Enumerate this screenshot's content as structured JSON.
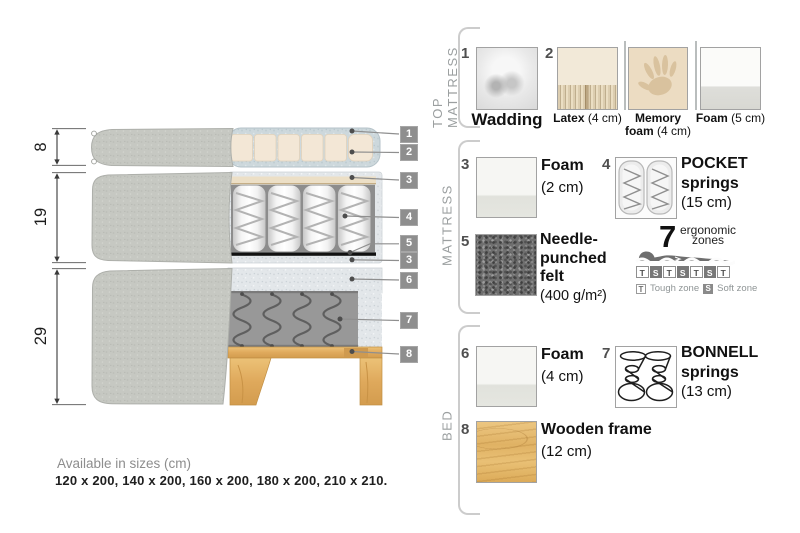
{
  "diagram": {
    "dim_top": "8",
    "dim_mid": "19",
    "dim_bottom": "29",
    "callouts": [
      "1",
      "2",
      "3",
      "4",
      "5",
      "3",
      "6",
      "7",
      "8"
    ]
  },
  "sections": {
    "top_mattress": {
      "label": "TOP MATTRESS"
    },
    "mattress": {
      "label": "MATTRESS"
    },
    "bed": {
      "label": "BED"
    }
  },
  "items": {
    "wadding": {
      "num": "1",
      "name": "Wadding"
    },
    "latex": {
      "num": "2",
      "name": "Latex",
      "size": "(4 cm)"
    },
    "memory_foam": {
      "name_line1": "Memory",
      "name_line2": "foam",
      "size": "(4 cm)"
    },
    "foam_top": {
      "name": "Foam",
      "size": "(5 cm)"
    },
    "foam_mattress": {
      "num": "3",
      "name": "Foam",
      "size": "(2 cm)"
    },
    "pocket_springs": {
      "num": "4",
      "name_line1": "POCKET",
      "name_line2": "springs",
      "size": "(15 cm)"
    },
    "felt": {
      "num": "5",
      "name_line1": "Needle-",
      "name_line2": "punched",
      "name_line3": "felt",
      "size": "(400 g/m²)"
    },
    "foam_bed": {
      "num": "6",
      "name": "Foam",
      "size": "(4 cm)"
    },
    "bonnell_springs": {
      "num": "7",
      "name_line1": "BONNELL",
      "name_line2": "springs",
      "size": "(13 cm)"
    },
    "wooden_frame": {
      "num": "8",
      "name": "Wooden frame",
      "size": "(12 cm)"
    }
  },
  "zones": {
    "count": "7",
    "label_line1": "ergonomic",
    "label_line2": "zones",
    "cells": [
      "T",
      "S",
      "T",
      "S",
      "T",
      "S",
      "T"
    ],
    "tough_key": "T",
    "tough_label": "Tough zone",
    "soft_key": "S",
    "soft_label": "Soft zone"
  },
  "footer": {
    "title": "Available in sizes (cm)",
    "sizes": "120 x 200, 140 x 200, 160 x 200, 180 x 200, 210 x 210."
  },
  "colors": {
    "fabric_gray": "#c6c8c2",
    "wadding_blue": "#cdd8dc",
    "latex_cream": "#f3e7d6",
    "felt_black": "#111111",
    "wood": "#dfa95c",
    "callout_bg": "#8e8e8e"
  }
}
